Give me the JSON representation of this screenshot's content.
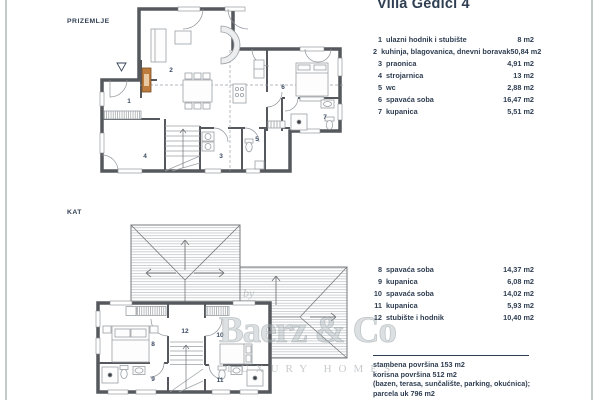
{
  "header": {
    "title": "Villa Gedici 4"
  },
  "floors": {
    "ground_label": "PRIZEMLJE",
    "upper_label": "KAT"
  },
  "ground_list": {
    "rows": [
      {
        "num": "1",
        "label": "ulazni hodnik i stubište",
        "value": "8 m2"
      },
      {
        "num": "2",
        "label": "kuhinja, blagovanica, dnevni boravak",
        "value": "50,84 m2"
      },
      {
        "num": "3",
        "label": "praonica",
        "value": "4,91 m2"
      },
      {
        "num": "4",
        "label": "strojarnica",
        "value": "13 m2"
      },
      {
        "num": "5",
        "label": "wc",
        "value": "2,88 m2"
      },
      {
        "num": "6",
        "label": "spavaća soba",
        "value": "16,47 m2"
      },
      {
        "num": "7",
        "label": "kupanica",
        "value": "5,51 m2"
      }
    ]
  },
  "upper_list": {
    "rows": [
      {
        "num": "8",
        "label": "spavaća soba",
        "value": "14,37 m2"
      },
      {
        "num": "9",
        "label": "kupanica",
        "value": "6,08 m2"
      },
      {
        "num": "10",
        "label": "spavaća soba",
        "value": "14,02 m2"
      },
      {
        "num": "11",
        "label": "kupanica",
        "value": "5,93 m2"
      },
      {
        "num": "12",
        "label": "stubište i hodnik",
        "value": "10,40 m2"
      }
    ]
  },
  "summary": {
    "lines": [
      "stambena površina 153 m2",
      "korisna površina 512 m2",
      "(bazen, terasa, sunčalište, parking, okućnica);",
      "parcela uk 796 m2"
    ]
  },
  "watermark": {
    "by": "by",
    "name": "Baerz & Co",
    "tagline": "LUXURY HOMES"
  },
  "plans": {
    "ground": {
      "rooms": [
        "1",
        "2",
        "3",
        "4",
        "5",
        "6",
        "7"
      ]
    },
    "upper": {
      "rooms": [
        "8",
        "9",
        "10",
        "11",
        "12"
      ]
    }
  },
  "colors": {
    "text": "#2f3e52",
    "wall": "#55585c",
    "fireplace": "#bd7b3e",
    "watermark": "#b9c0c4"
  }
}
